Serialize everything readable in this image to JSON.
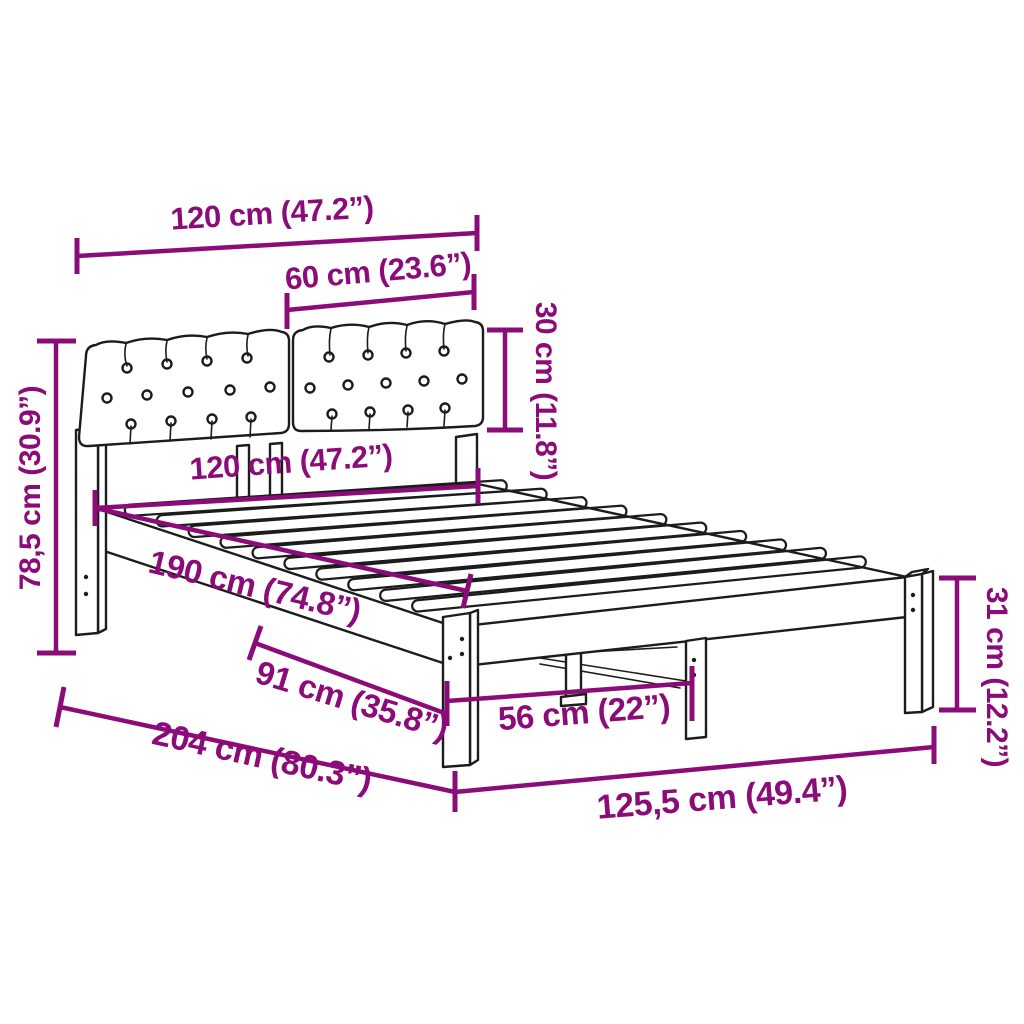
{
  "image_type": "product-dimension-diagram",
  "product": "bed frame with upholstered tufted headboard and slatted base",
  "colors": {
    "dimension_accent": "#8b0c78",
    "line_art": "#1c1c1c",
    "background": "#ffffff"
  },
  "dimensions": {
    "top_width": {
      "label": "120 cm (47.2”)"
    },
    "cushion_width": {
      "label": "60 cm (23.6”)"
    },
    "cushion_height": {
      "label": "30 cm (11.8”)"
    },
    "bed_width": {
      "label": "120 cm (47.2”)"
    },
    "headboard_height": {
      "label": "78,5 cm (30.9”)"
    },
    "slat_length": {
      "label": "190 cm (74.8”)"
    },
    "leg_height": {
      "label": "31 cm (12.2”)"
    },
    "under_length": {
      "label": "91 cm (35.8”)"
    },
    "total_length": {
      "label": "204 cm (80.3”)"
    },
    "leg_spacing": {
      "label": "56 cm (22”)"
    },
    "total_width": {
      "label": "125,5 cm (49.4”)"
    }
  }
}
